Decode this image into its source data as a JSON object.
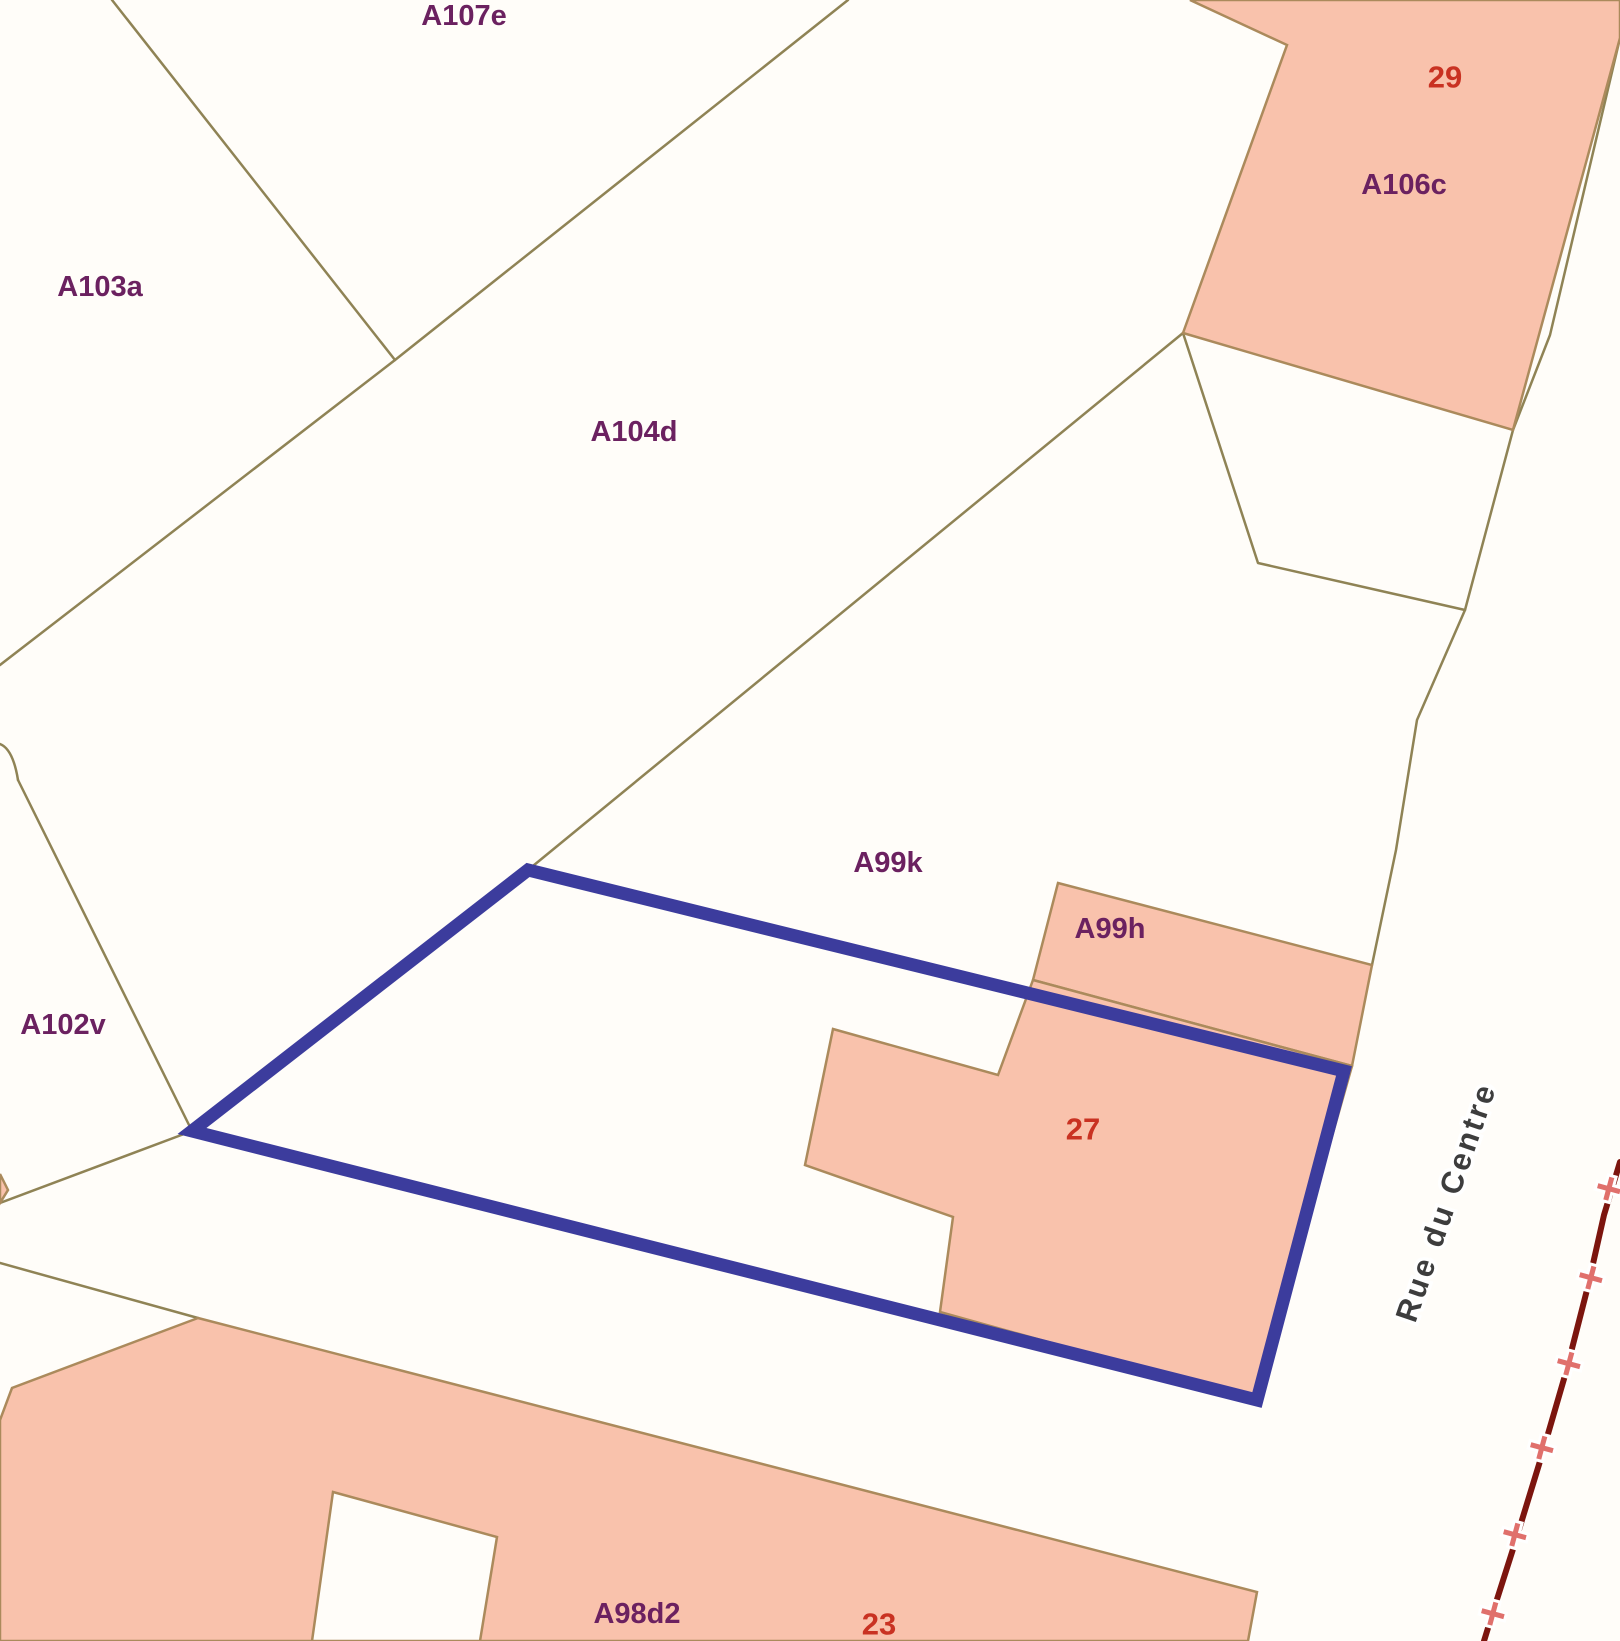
{
  "map": {
    "background_color": "#fffdf9",
    "palette": {
      "parcel_line": "#8f8355",
      "building_fill": "#f9c2ac",
      "building_stroke": "#ab8a5c",
      "highlight_blue": "#3c3c9d",
      "label_purple": "#6b2160",
      "label_red": "#c93222",
      "street_text": "#3d3d3d",
      "street_halo": "#ffffff",
      "admin_boundary": "#7c150e",
      "cross_pink": "#e0706c"
    },
    "street": {
      "name": "Rue du Centre",
      "x": 1446,
      "y": 1202,
      "rotation": -71,
      "font_size": 31,
      "letter_spacing": 3
    },
    "labels": [
      {
        "id": "a107e",
        "text": "A107e",
        "x": 464,
        "y": 16,
        "role": "parcel"
      },
      {
        "id": "a103a",
        "text": "A103a",
        "x": 100,
        "y": 287,
        "role": "parcel"
      },
      {
        "id": "a104d",
        "text": "A104d",
        "x": 634,
        "y": 432,
        "role": "parcel"
      },
      {
        "id": "a102v",
        "text": "A102v",
        "x": 63,
        "y": 1025,
        "role": "parcel"
      },
      {
        "id": "a99k",
        "text": "A99k",
        "x": 888,
        "y": 863,
        "role": "parcel"
      },
      {
        "id": "a99h",
        "text": "A99h",
        "x": 1110,
        "y": 929,
        "role": "parcel"
      },
      {
        "id": "a106c",
        "text": "A106c",
        "x": 1404,
        "y": 185,
        "role": "parcel"
      },
      {
        "id": "a98d2",
        "text": "A98d2",
        "x": 637,
        "y": 1614,
        "role": "parcel"
      },
      {
        "id": "n29",
        "text": "29",
        "x": 1445,
        "y": 77,
        "role": "house-number"
      },
      {
        "id": "n27",
        "text": "27",
        "x": 1083,
        "y": 1129,
        "role": "house-number"
      },
      {
        "id": "n23",
        "text": "23",
        "x": 879,
        "y": 1624,
        "role": "house-number"
      }
    ],
    "parcel_lines": [
      {
        "id": "boundary-a103a-a107e",
        "points": "112,0 395,360"
      },
      {
        "id": "boundary-a107e-a104d",
        "points": "848,0 395,360 0,665"
      },
      {
        "id": "boundary-a104d-a99k",
        "points": "1183,333 528,870"
      },
      {
        "id": "boundary-a102v-east",
        "points": "18,780 192,1131"
      },
      {
        "id": "boundary-a102v-corner-arc",
        "path": "M 0,744 Q 13,749 18,780"
      },
      {
        "id": "boundary-apex-southwest",
        "points": "192,1131 0,1203"
      },
      {
        "id": "boundary-a98-north",
        "points": "0,1263 198,1318"
      },
      {
        "id": "boundary-street-west",
        "points": "1620,38 1550,335 1513,430 1465,610 1417,720 1396,850 1372,965"
      },
      {
        "id": "boundary-wedge-below-a106c",
        "points": "1183,333 1258,563 1465,610"
      }
    ],
    "buildings": [
      {
        "id": "building-a106c-29",
        "points": "1190,0 1287,45 1183,333 1513,430 1620,38 1620,0"
      },
      {
        "id": "building-a99h",
        "points": "1058,883 1372,965 1352,1066 1033,980"
      },
      {
        "id": "building-27",
        "points": "833,1029 998,1075 1033,980 1352,1066 1257,1400 940,1312 953,1217 805,1165"
      },
      {
        "id": "building-23-a98d2",
        "points": "198,1318 1257,1592 1248,1641 0,1641 0,1420 12,1388"
      },
      {
        "id": "building-sliver-west",
        "points": "0,1174 8,1190 0,1203"
      }
    ],
    "courtyard": {
      "id": "courtyard-23",
      "points": "333,1492 497,1537 480,1641 312,1641"
    },
    "highlight": {
      "id": "selected-parcel-outline",
      "points": "192,1131 528,870 1344,1071 1257,1400",
      "stroke_width": 13
    },
    "admin_boundary": {
      "points": "1620,1162 1604,1215 1588,1286 1566,1372 1541,1458 1514,1546 1492,1615 1484,1641",
      "stroke_width": 6,
      "crosses": [
        {
          "x": 1609,
          "y": 1188
        },
        {
          "x": 1591,
          "y": 1277
        },
        {
          "x": 1569,
          "y": 1363
        },
        {
          "x": 1542,
          "y": 1447
        },
        {
          "x": 1515,
          "y": 1534
        },
        {
          "x": 1493,
          "y": 1613
        }
      ]
    }
  }
}
